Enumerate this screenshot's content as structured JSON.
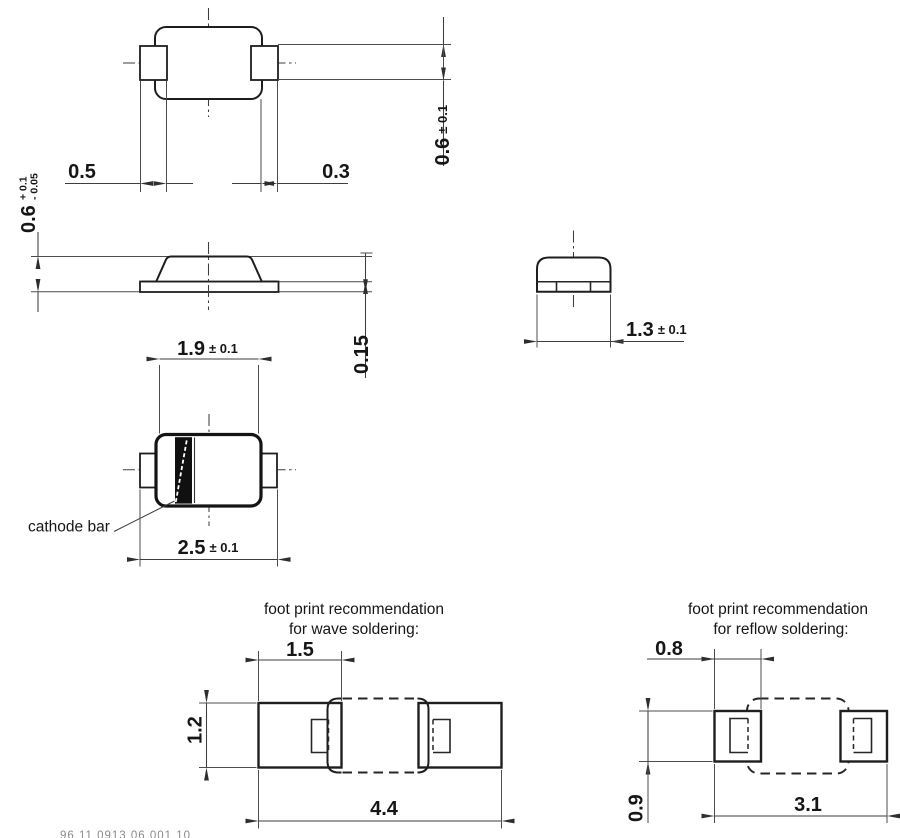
{
  "drawing": {
    "top_view": {
      "tab_length": "0.5",
      "tab_overhang": "0.3",
      "terminal_width": "0.6",
      "terminal_width_tol": "± 0.1"
    },
    "side_view": {
      "height": "0.6",
      "height_tol_plus": "+ 0.1",
      "height_tol_minus": "- 0.05",
      "lead_thickness": "0.15"
    },
    "end_view": {
      "width": "1.3",
      "width_tol": "± 0.1"
    },
    "bottom_view": {
      "body_length": "1.9",
      "body_length_tol": "± 0.1",
      "total_length": "2.5",
      "total_length_tol": "± 0.1",
      "cathode_label": "cathode bar"
    },
    "footprint_wave": {
      "title_line1": "foot print recommendation",
      "title_line2": "for wave soldering:",
      "pad_width": "1.5",
      "pad_height": "1.2",
      "overall_length": "4.4"
    },
    "footprint_reflow": {
      "title_line1": "foot print recommendation",
      "title_line2": "for reflow soldering:",
      "pad_width": "0.8",
      "pad_height": "0.9",
      "overall_length": "3.1"
    },
    "footer_code": "96 11 0913 06 001 10"
  },
  "colors": {
    "background": "#ffffff",
    "outline": "#1e1e1e",
    "dimension_lines": "#3e3e3e",
    "text": "#161616",
    "cathode_bar": "#101010"
  }
}
